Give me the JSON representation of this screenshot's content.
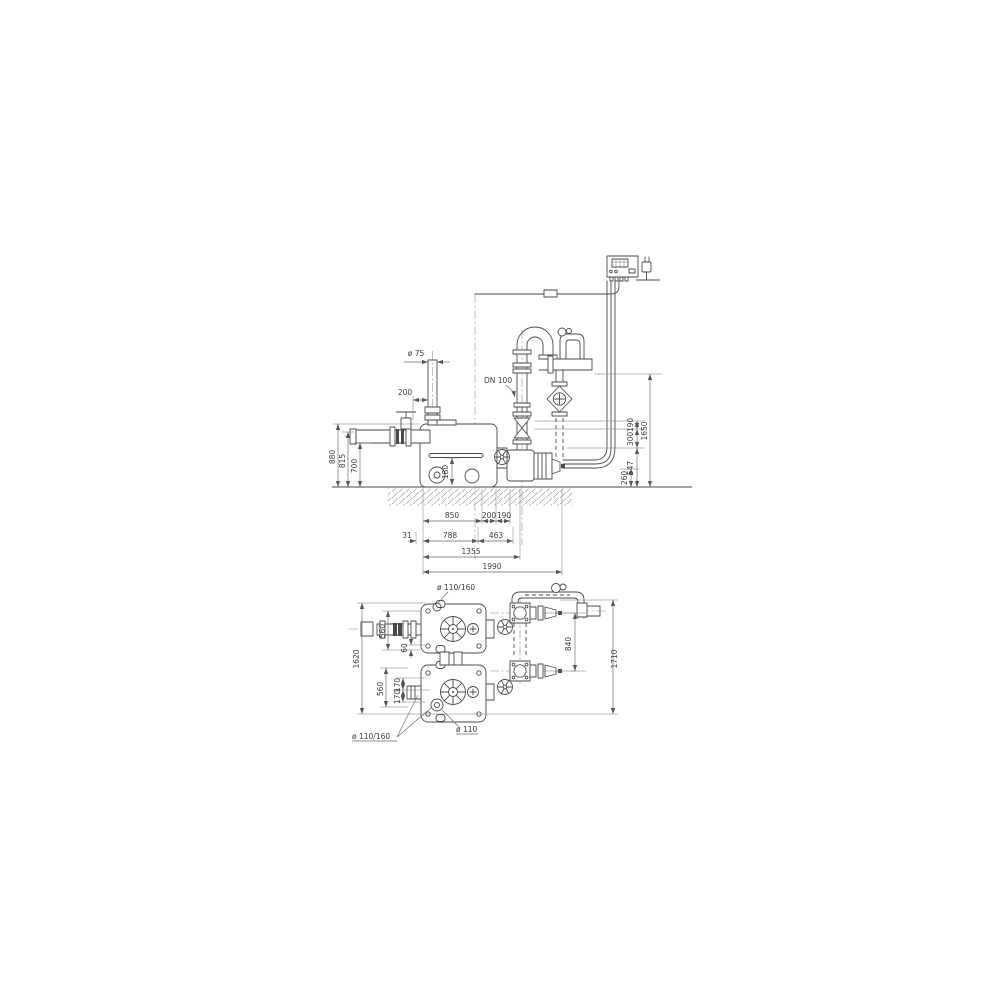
{
  "title": "Duplex lifting unit dimensional drawing",
  "colors": {
    "background": "#ffffff",
    "line": "#4a4a4a",
    "dimension_line": "#666666",
    "text": "#3c3c3c"
  },
  "side_view": {
    "vent_diameter": "ø 75",
    "vent_offset": "200",
    "discharge_label": "DN 100",
    "height_overall": "880",
    "height_inlet_center": "815",
    "height_inlet_bottom": "700",
    "height_port": "180",
    "right_seg_190": "190",
    "right_seg_300": "300",
    "right_overall": "1650",
    "right_seg_547": "547",
    "right_seg_260": "260",
    "bottom_850": "850",
    "bottom_200": "200",
    "bottom_190": "190",
    "bottom_31": "31",
    "bottom_788": "788",
    "bottom_463": "463",
    "bottom_1355": "1355",
    "bottom_1990": "1990"
  },
  "plan_view": {
    "inlet_port_top": "ø 110/160",
    "width_560_top": "560",
    "offset_60": "60",
    "length_overall_left": "1620",
    "width_560_bottom": "560",
    "offset_170_a": "170",
    "offset_170_b": "170",
    "branch_spacing": "840",
    "length_overall_right": "1710",
    "inlet_port_side": "ø 110/160",
    "drain_port": "ø 110"
  }
}
